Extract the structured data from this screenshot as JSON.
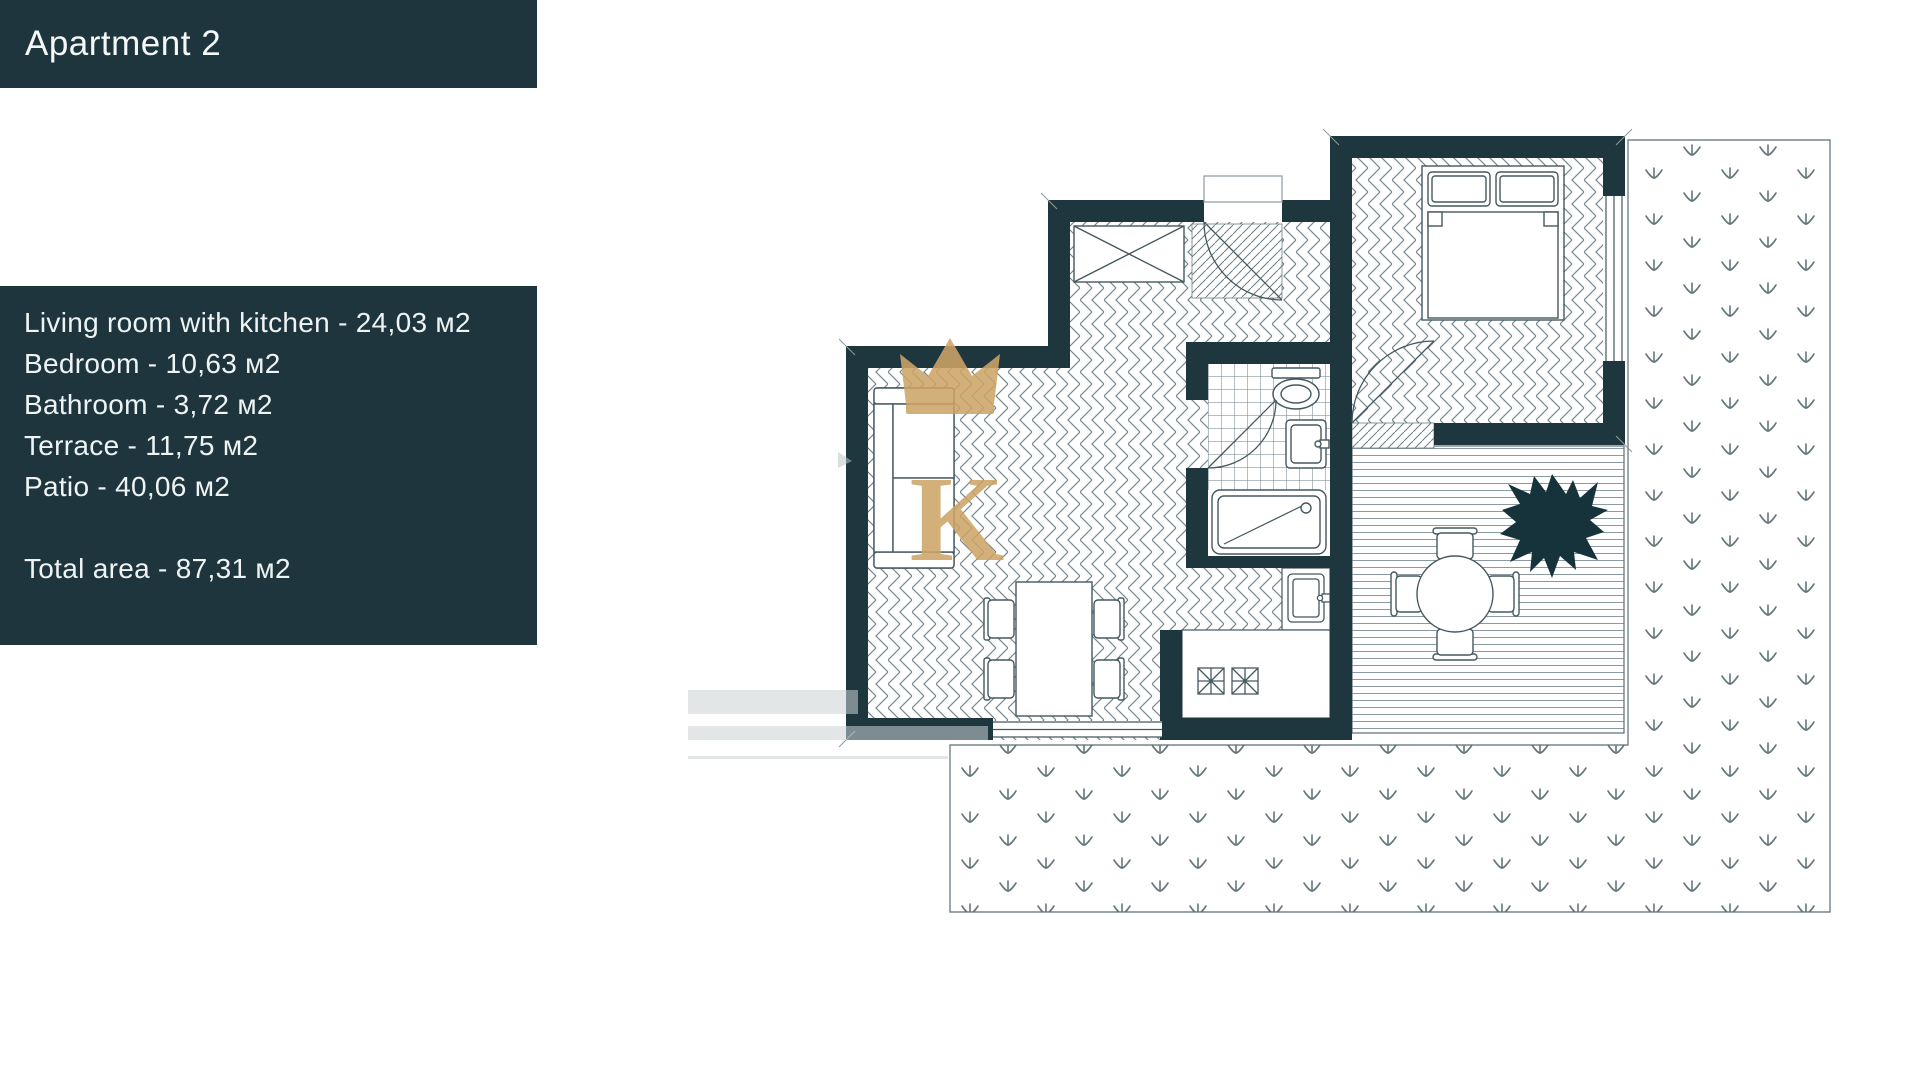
{
  "header": {
    "title": "Apartment 2"
  },
  "info": {
    "lines": [
      "Living room with kitchen - 24,03 м2",
      "Bedroom - 10,63 м2",
      "Bathroom - 3,72 м2",
      "Terrace - 11,75 м2",
      "Patio - 40,06 м2"
    ],
    "total": "Total area - 87,31 м2"
  },
  "watermark": {
    "letter": "K"
  },
  "colors": {
    "panel": "#1f353d",
    "wall": "#1e363e",
    "gold": "#cda467",
    "linework": "#6b7e84"
  },
  "floor_plan": {
    "areas": [
      "entry",
      "living-room-with-kitchen",
      "bathroom",
      "bedroom",
      "terrace",
      "patio"
    ],
    "furniture": [
      "wardrobe",
      "sofa",
      "dining-table",
      "kitchen-stove",
      "kitchen-sink",
      "bathtub",
      "toilet",
      "washbasin",
      "double-bed",
      "round-table",
      "chairs",
      "plant"
    ]
  }
}
